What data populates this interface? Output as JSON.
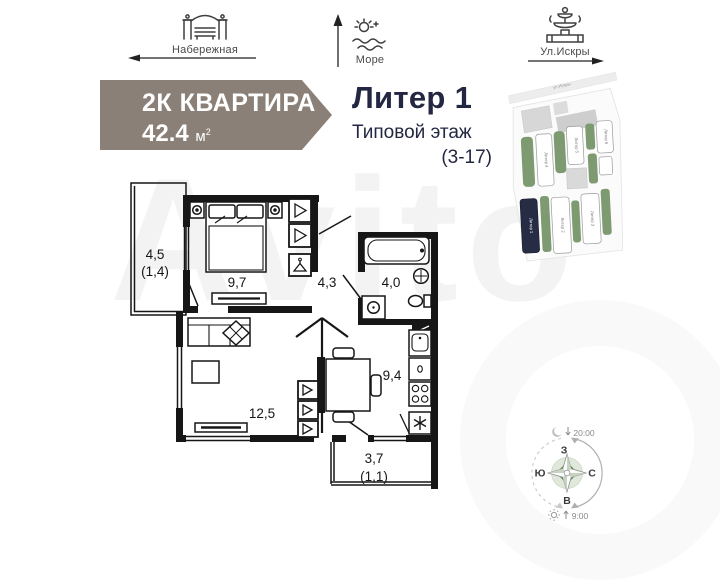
{
  "landmarks": {
    "items": [
      {
        "label": "Набережная",
        "icon": "embankment-icon",
        "direction": "left"
      },
      {
        "label": "Море",
        "icon": "sea-icon",
        "direction": "up"
      },
      {
        "label": "Ул.Искры",
        "icon": "fountain-icon",
        "direction": "right"
      }
    ]
  },
  "badge": {
    "type_label": "2К КВАРТИРА",
    "area_value": "42.4",
    "area_unit": "м",
    "area_sup": "2",
    "color": "#8b8078"
  },
  "header": {
    "building": "Литер 1",
    "floor_type": "Типовой этаж",
    "floor_range": "(3-17)"
  },
  "floor_plan": {
    "rooms": {
      "balcony_top": {
        "area": "4,5",
        "reduced": "(1,4)"
      },
      "bedroom": {
        "area": "9,7"
      },
      "hall": {
        "area": "4,3"
      },
      "bathroom": {
        "area": "4,0"
      },
      "living_room": {
        "area": "12,5"
      },
      "kitchen": {
        "area": "9,4"
      },
      "balcony_bottom": {
        "area": "3,7",
        "reduced": "(1,1)"
      }
    }
  },
  "site_plan": {
    "street_label": "ул.Искры",
    "highlighted_building": "Литер 1",
    "building_labels": [
      "Литер 2",
      "Литер 3",
      "Литер 4",
      "Литер 5",
      "Литер 6"
    ],
    "highlight_color": "#272c45",
    "green_color": "#7d9a71"
  },
  "compass": {
    "west": "З",
    "south": "Ю",
    "north": "С",
    "east": "В",
    "sunset_time": "20:00",
    "sunrise_time": "9:00"
  },
  "watermark": "Avito"
}
